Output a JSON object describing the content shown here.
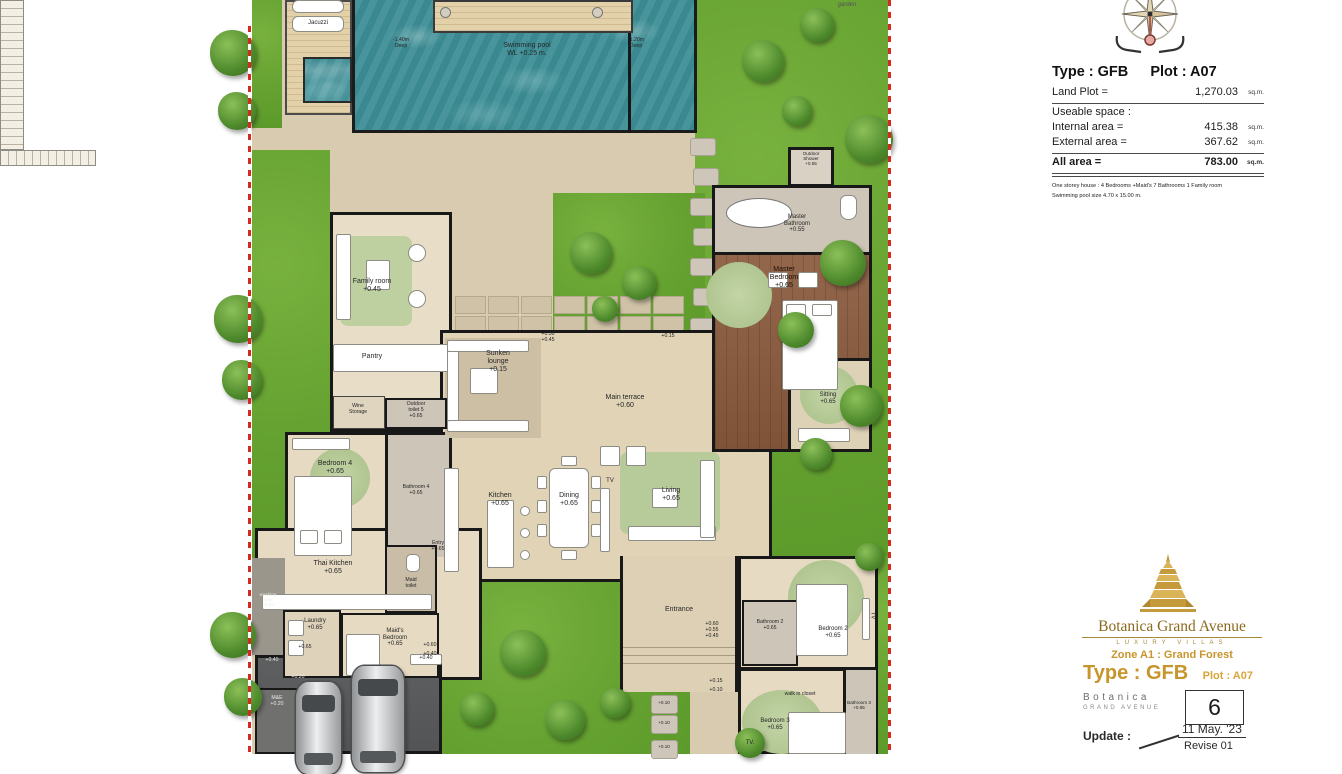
{
  "info_panel": {
    "type_label": "Type : GFB",
    "plot_label": "Plot : A07",
    "land_plot_label": "Land Plot =",
    "land_plot_value": "1,270.03",
    "unit": "sq.m.",
    "useable_label": "Useable space :",
    "internal_label": "Internal area =",
    "internal_value": "415.38",
    "external_label": "External area =",
    "external_value": "367.62",
    "all_label": "All area =",
    "all_value": "783.00",
    "note1": "One storey house : 4 Bedrooms +Maid's 7 Bathrooms 1 Family room",
    "note2": "Swimming pool size  4.70 x 15.00 m."
  },
  "title_block": {
    "brand": "Botanica Grand Avenue",
    "tagline": "Luxury villas",
    "zone": "Zone A1 : Grand Forest",
    "type": "Type : GFB",
    "plot": "Plot : A07",
    "brand_word": "Botanica",
    "brand_sub": "Grand Avenue",
    "plot_number": "6",
    "update_label": "Update :",
    "update_date": "11 May. '23",
    "revise": "Revise 01"
  },
  "plan": {
    "garden_note": "garden",
    "pool": {
      "label": "Swimming pool",
      "water_level": "WL +0.25 m.",
      "deep_left_1": "-1.40m",
      "deep_left_2": "Deep",
      "deep_right_1": "-1.20m",
      "deep_right_2": "Deep",
      "jacuzzi": "Jacuzzi"
    },
    "rooms": {
      "family": {
        "label": "Family room",
        "level": "+0.45"
      },
      "pantry": {
        "label": "Pantry"
      },
      "wine": {
        "label": "Wine",
        "label2": "Storage"
      },
      "outdoor_toilet": {
        "label": "Outdoor",
        "label2": "toilet 5",
        "level": "+0.65"
      },
      "sunken": {
        "label": "Sunken",
        "label2": "lounge",
        "level": "+0.15"
      },
      "terrace": {
        "label": "Main terrace",
        "level": "+0.60"
      },
      "master_bedroom": {
        "label": "Master",
        "label2": "Bedroom",
        "level": "+0.65"
      },
      "master_bathroom": {
        "label": "Master",
        "label2": "Bathroom",
        "level": "+0.55"
      },
      "outdoor_shower": {
        "label": "Outdoor",
        "label2": "Shower",
        "level": "+0.55"
      },
      "sitting": {
        "label": "Sitting",
        "level": "+0.65"
      },
      "kitchen": {
        "label": "Kitchen",
        "level": "+0.65"
      },
      "dining": {
        "label": "Dining",
        "level": "+0.65"
      },
      "living": {
        "label": "Living",
        "level": "+0.65"
      },
      "tv_living": "TV",
      "bedroom4": {
        "label": "Bedroom 4",
        "level": "+0.65"
      },
      "bathroom4": {
        "label": "Bathroom 4",
        "level": "+0.65"
      },
      "entry": {
        "label": "Entry",
        "level": "+0.65"
      },
      "thai_kitchen": {
        "label": "Thai Kitchen",
        "level": "+0.65"
      },
      "maid_toilet": {
        "label": "Maid",
        "label2": "toilet"
      },
      "laundry": {
        "label": "Laundry",
        "level": "+0.65"
      },
      "maids_bedroom": {
        "label": "Maid's",
        "label2": "Bedroom",
        "level": "+0.65"
      },
      "washing": {
        "label": "washing",
        "label2": "area",
        "level": "+0.55"
      },
      "me": {
        "label": "M&E",
        "level": "+0.20"
      },
      "entrance": {
        "label": "Entrance",
        "level1": "+0.60",
        "level2": "+0.55",
        "level3": "+0.45"
      },
      "bathroom2": {
        "label": "Bathroom 2",
        "level": "+0.65"
      },
      "bedroom2": {
        "label": "Bedroom 2",
        "level": "+0.65"
      },
      "tv_bedroom2": "TV",
      "walk_in_closet": "walk in closet",
      "bedroom3": {
        "label": "Bedroom 3",
        "level": "+0.65"
      },
      "bathroom3": {
        "label": "Bathroom 3",
        "level": "+0.65"
      },
      "tv_bedroom3": "TV."
    },
    "level_marks": {
      "m030": "+0.30",
      "m045": "+0.45",
      "m015": "+0.15",
      "g040a": "+0.40",
      "g020": "+0.20",
      "g040box": "+0.40",
      "p015": "+0.15",
      "p010": "+0.10",
      "s010a": "+0.10",
      "s010b": "+0.10",
      "s010c": "+0.10",
      "mb060": "+0.60",
      "mb040": "+0.40",
      "l065a": "+0.65"
    }
  }
}
